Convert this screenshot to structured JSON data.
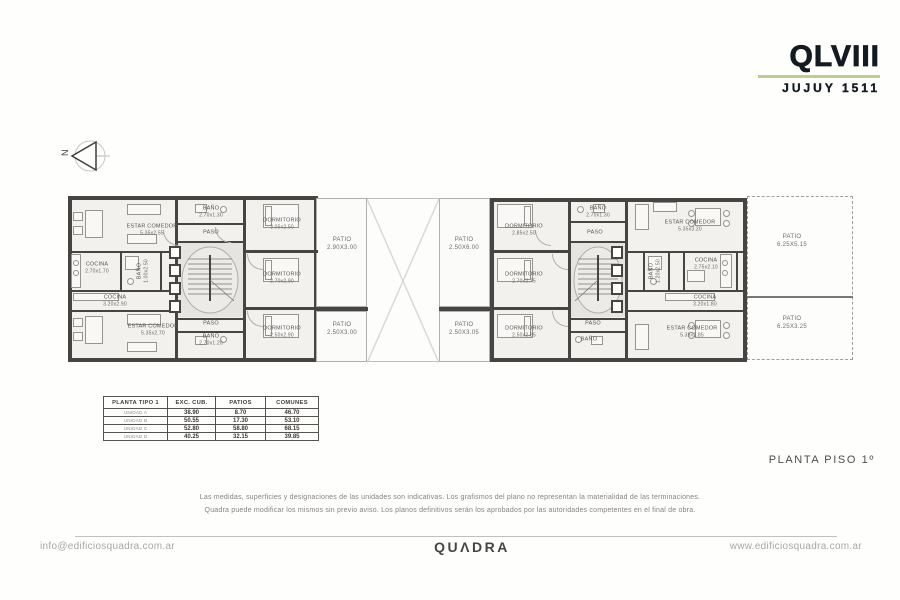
{
  "logo": {
    "title": "QLVIII",
    "subtitle": "JUJUY 1511",
    "underline_color": "#bccd90"
  },
  "plan": {
    "title": "PLANTA PISO 1º",
    "north_label": "N",
    "rooms": {
      "estar_tl": {
        "name": "ESTAR COMEDOR",
        "dims": "5.35x2.55"
      },
      "cocina_tl": {
        "name": "COCINA",
        "dims": "2.70x1.70"
      },
      "bano_lv": {
        "name": "BAÑO",
        "dims": "1.00x2.50"
      },
      "cocina_bl": {
        "name": "COCINA",
        "dims": "3.20x2.90"
      },
      "estar_bl": {
        "name": "ESTAR COMEDOR",
        "dims": "5.35x2.70"
      },
      "paso_t": {
        "name": "PASO"
      },
      "bano_ct": {
        "name": "BAÑO",
        "dims": "2.70x1.30"
      },
      "paso_b": {
        "name": "PASO"
      },
      "bano_cb": {
        "name": "BAÑO",
        "dims": "2.70x1.20"
      },
      "dorm_a": {
        "name": "DORMITORIO",
        "dims": "3.05x2.50"
      },
      "dorm_b": {
        "name": "DORMITORIO",
        "dims": "2.70x2.90"
      },
      "dorm_c": {
        "name": "DORMITORIO",
        "dims": "2.50x2.90"
      },
      "dorm_d": {
        "name": "DORMITORIO",
        "dims": "2.85x2.50"
      },
      "dorm_e": {
        "name": "DORMITORIO",
        "dims": "2.70x2.75"
      },
      "dorm_f": {
        "name": "DORMITORIO",
        "dims": "2.50x2.85"
      },
      "bano_rt": {
        "name": "BAÑO",
        "dims": "2.70x1.30"
      },
      "paso_rt": {
        "name": "PASO"
      },
      "paso_rb": {
        "name": "PASO"
      },
      "bano_rb": {
        "name": "BAÑO"
      },
      "estar_rt": {
        "name": "ESTAR COMEDOR",
        "dims": "5.35x3.20"
      },
      "cocina_rt": {
        "name": "COCINA",
        "dims": "2.75x2.10"
      },
      "bano_rv": {
        "name": "BAÑO",
        "dims": "1.20x2.50"
      },
      "cocina_rb": {
        "name": "COCINA",
        "dims": "3.20x1.80"
      },
      "estar_rb": {
        "name": "ESTAR COMEDOR",
        "dims": "5.35x2.85"
      }
    },
    "patios": {
      "lt": {
        "name": "PATIO",
        "dims": "2.90X3.00"
      },
      "lb": {
        "name": "PATIO",
        "dims": "2.50X3.00"
      },
      "rt": {
        "name": "PATIO",
        "dims": "2.50X6.00"
      },
      "rb": {
        "name": "PATIO",
        "dims": "2.50X3.05"
      },
      "ft": {
        "name": "PATIO",
        "dims": "6.25X5.15"
      },
      "fb": {
        "name": "PATIO",
        "dims": "6.25X3.25"
      }
    }
  },
  "table": {
    "headers": [
      "PLANTA TIPO 1",
      "EXC. CUB.",
      "PATIOS",
      "COMUNES"
    ],
    "rows": [
      {
        "unit": "UNIDAD A",
        "exc_cub": "38.90",
        "patios": "8.70",
        "comunes": "46.70"
      },
      {
        "unit": "UNIDAD B",
        "exc_cub": "50.55",
        "patios": "17.30",
        "comunes": "53.10"
      },
      {
        "unit": "UNIDAD C",
        "exc_cub": "52.80",
        "patios": "58.80",
        "comunes": "68.15"
      },
      {
        "unit": "UNIDAD D",
        "exc_cub": "40.25",
        "patios": "32.15",
        "comunes": "39.85"
      }
    ]
  },
  "disclaimer": {
    "line1": "Las medidas, superficies y designaciones de las unidades son indicativas. Los grafismos del plano no representan la materialidad de las terminaciones.",
    "line2": "Quadra puede modificar los mismos sin previo aviso. Los planos definitivos serán los aprobados por las autoridades competentes en el final de obra."
  },
  "footer": {
    "email": "info@edificiosquadra.com.ar",
    "brand": "QUΛDRA",
    "website": "www.edificiosquadra.com.ar"
  }
}
